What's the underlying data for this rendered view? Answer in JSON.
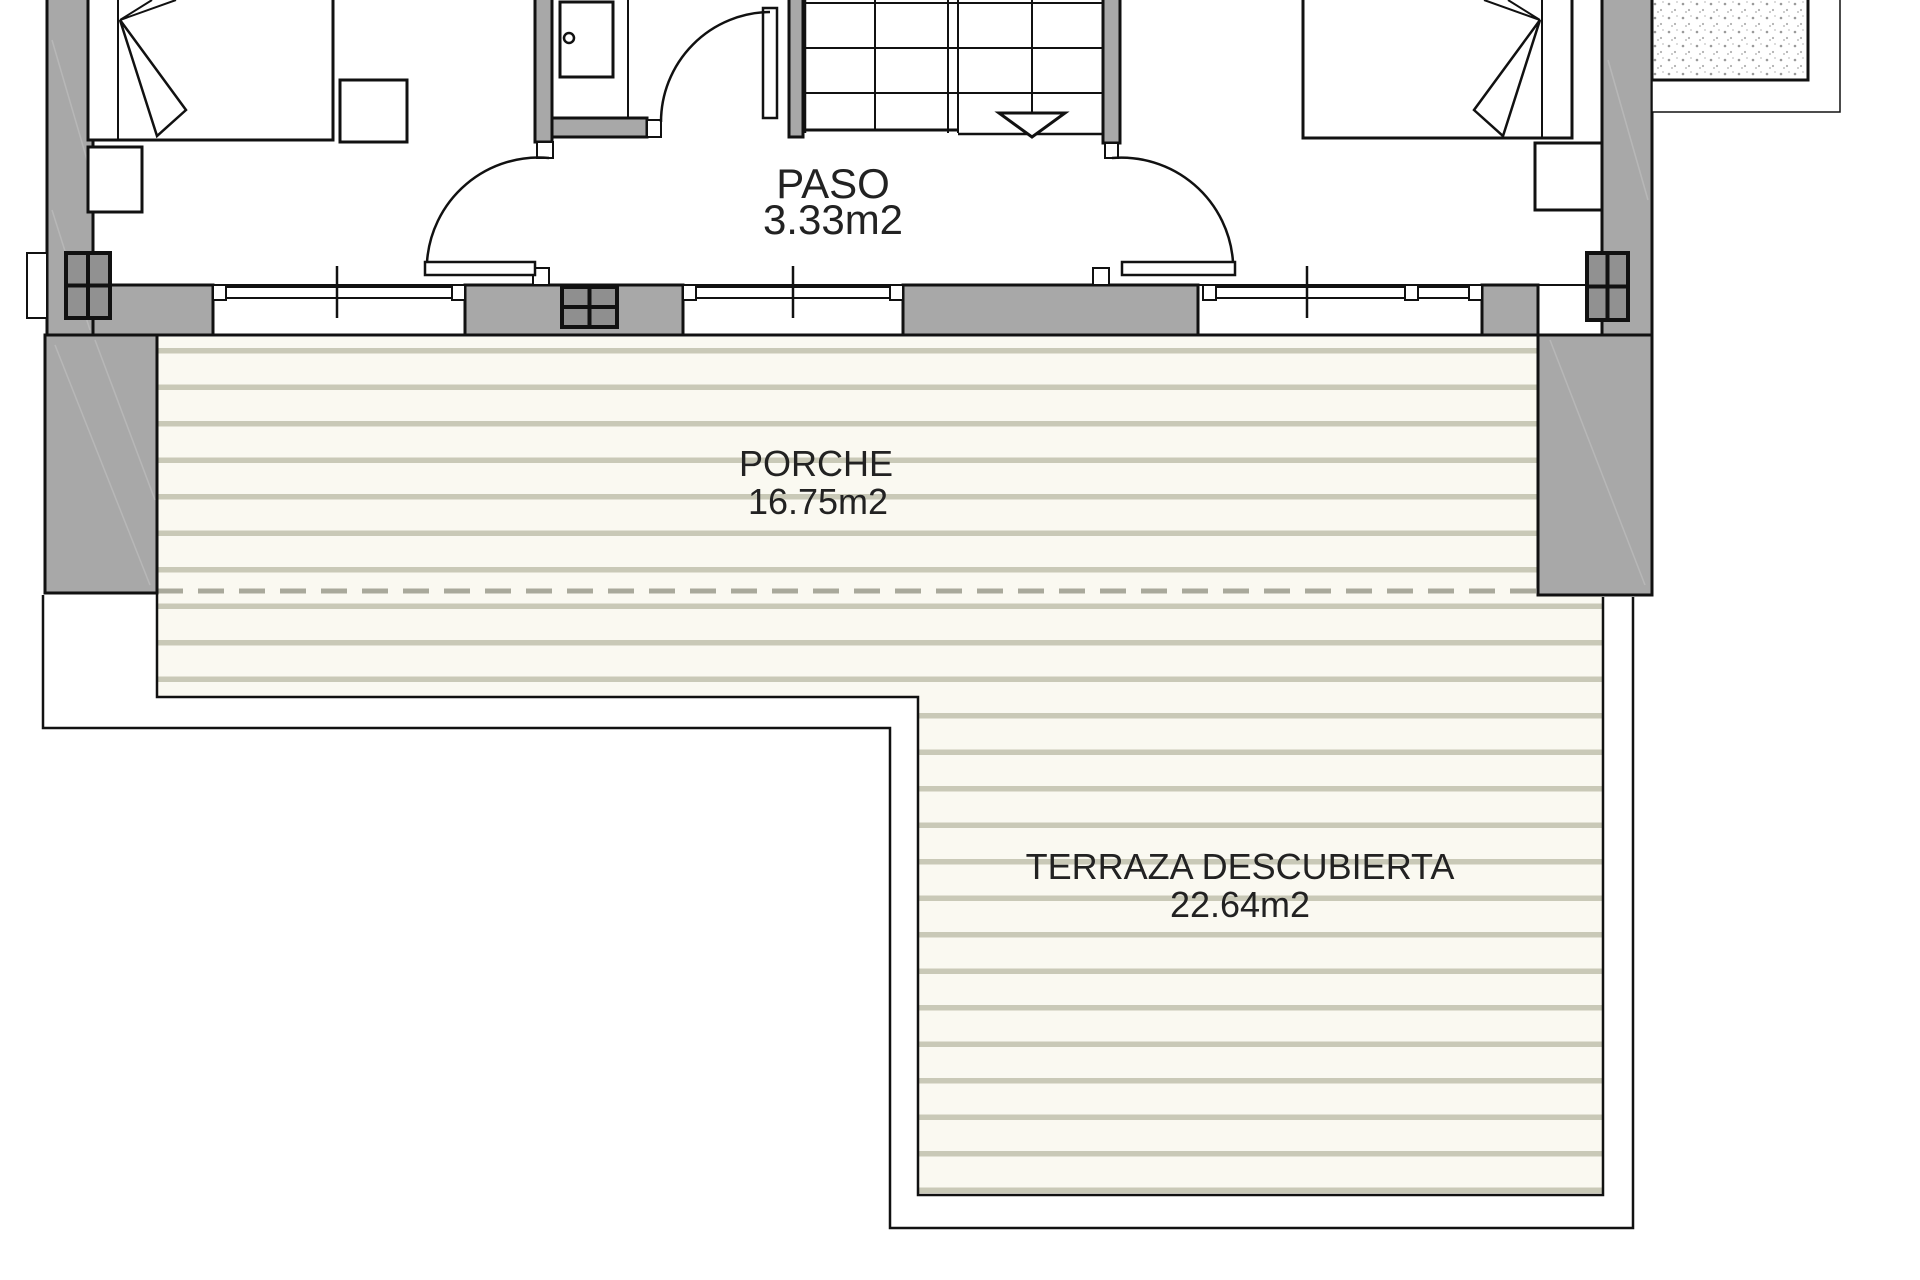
{
  "rooms": {
    "paso": {
      "name": "PASO",
      "area": "3.33m2"
    },
    "porche": {
      "name": "PORCHE",
      "area": "16.75m2"
    },
    "terraza": {
      "name": "TERRAZA DESCUBIERTA",
      "area": "22.64m2"
    }
  },
  "palette": {
    "wall_fill": "#a8a8a8",
    "column_fill": "#919191",
    "line_color": "#111111",
    "deck_background": "#faf9f1",
    "deck_stripe": "#c9c9b7",
    "deck_dashed_edge": "#a9a99b",
    "label_text": "#222222"
  }
}
